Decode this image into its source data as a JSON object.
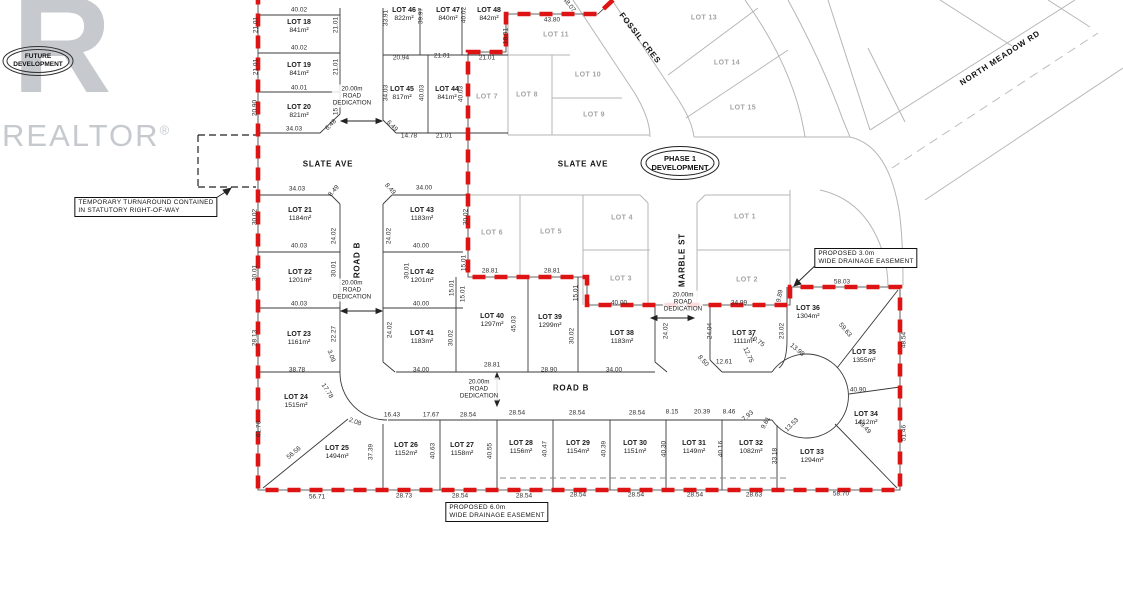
{
  "watermark": {
    "logo_letter": "R",
    "brand": "REALTOR",
    "registered": "®"
  },
  "stamps": [
    {
      "id": "future",
      "line1": "FUTURE",
      "line2": "DEVELOPMENT",
      "x": 38,
      "y": 61
    },
    {
      "id": "phase1",
      "line1": "PHASE 1",
      "line2": "DEVELOPMENT",
      "x": 680,
      "y": 163
    }
  ],
  "streets": [
    {
      "name": "SLATE AVE",
      "x": 328,
      "y": 164,
      "r": 0
    },
    {
      "name": "SLATE AVE",
      "x": 583,
      "y": 164,
      "r": 0
    },
    {
      "name": "FOSSIL CRES",
      "x": 640,
      "y": 38,
      "r": 52
    },
    {
      "name": "NORTH MEADOW RD",
      "x": 1000,
      "y": 58,
      "r": -33
    },
    {
      "name": "MARBLE ST",
      "x": 682,
      "y": 260,
      "r": -90
    },
    {
      "name": "ROAD B",
      "x": 357,
      "y": 260,
      "r": -90
    },
    {
      "name": "ROAD B",
      "x": 571,
      "y": 388,
      "r": 0
    }
  ],
  "dedications": [
    {
      "l1": "20.00m",
      "l2": "ROAD",
      "l3": "DEDICATION",
      "x": 352,
      "y": 96
    },
    {
      "l1": "20.00m",
      "l2": "ROAD",
      "l3": "DEDICATION",
      "x": 352,
      "y": 290
    },
    {
      "l1": "20.00m",
      "l2": "ROAD",
      "l3": "DEDICATION",
      "x": 683,
      "y": 302
    },
    {
      "l1": "20.00m",
      "l2": "ROAD",
      "l3": "DEDICATION",
      "x": 479,
      "y": 389
    }
  ],
  "notes": [
    {
      "l1": "TEMPORARY TURNAROUND CONTAINED",
      "l2": "IN STATUTORY RIGHT-OF-WAY",
      "x": 146,
      "y": 207
    },
    {
      "l1": "PROPOSED 3.0m",
      "l2": "WIDE DRAINAGE EASEMENT",
      "x": 866,
      "y": 258
    },
    {
      "l1": "PROPOSED 6.0m",
      "l2": "WIDE DRAINAGE EASEMENT",
      "x": 497,
      "y": 512
    }
  ],
  "phase_lots": [
    {
      "name": "LOT 18",
      "area": "841m²",
      "x": 299,
      "y": 27
    },
    {
      "name": "LOT 19",
      "area": "841m²",
      "x": 299,
      "y": 70
    },
    {
      "name": "LOT 20",
      "area": "821m²",
      "x": 299,
      "y": 112
    },
    {
      "name": "LOT 21",
      "area": "1184m²",
      "x": 300,
      "y": 215
    },
    {
      "name": "LOT 22",
      "area": "1201m²",
      "x": 300,
      "y": 277
    },
    {
      "name": "LOT 23",
      "area": "1161m²",
      "x": 299,
      "y": 339
    },
    {
      "name": "LOT 24",
      "area": "1515m²",
      "x": 296,
      "y": 402
    },
    {
      "name": "LOT 25",
      "area": "1494m²",
      "x": 337,
      "y": 453
    },
    {
      "name": "LOT 26",
      "area": "1152m²",
      "x": 406,
      "y": 450
    },
    {
      "name": "LOT 27",
      "area": "1158m²",
      "x": 462,
      "y": 450
    },
    {
      "name": "LOT 28",
      "area": "1156m²",
      "x": 521,
      "y": 448
    },
    {
      "name": "LOT 29",
      "area": "1154m²",
      "x": 578,
      "y": 448
    },
    {
      "name": "LOT 30",
      "area": "1151m²",
      "x": 635,
      "y": 448
    },
    {
      "name": "LOT 31",
      "area": "1149m²",
      "x": 694,
      "y": 448
    },
    {
      "name": "LOT 32",
      "area": "1082m²",
      "x": 751,
      "y": 448
    },
    {
      "name": "LOT 33",
      "area": "1294m²",
      "x": 812,
      "y": 457
    },
    {
      "name": "LOT 34",
      "area": "1412m²",
      "x": 866,
      "y": 419
    },
    {
      "name": "LOT 35",
      "area": "1355m²",
      "x": 864,
      "y": 357
    },
    {
      "name": "LOT 36",
      "area": "1304m²",
      "x": 808,
      "y": 313
    },
    {
      "name": "LOT 37",
      "area": "1111m²",
      "x": 744,
      "y": 338
    },
    {
      "name": "LOT 38",
      "area": "1183m²",
      "x": 622,
      "y": 338
    },
    {
      "name": "LOT 39",
      "area": "1299m²",
      "x": 550,
      "y": 322
    },
    {
      "name": "LOT 40",
      "area": "1297m²",
      "x": 492,
      "y": 321
    },
    {
      "name": "LOT 41",
      "area": "1183m²",
      "x": 422,
      "y": 338
    },
    {
      "name": "LOT 42",
      "area": "1201m²",
      "x": 422,
      "y": 277
    },
    {
      "name": "LOT 43",
      "area": "1183m²",
      "x": 422,
      "y": 215
    },
    {
      "name": "LOT 44",
      "area": "841m²",
      "x": 447,
      "y": 94
    },
    {
      "name": "LOT 45",
      "area": "817m²",
      "x": 402,
      "y": 94
    },
    {
      "name": "LOT 46",
      "area": "822m²",
      "x": 404,
      "y": 15
    },
    {
      "name": "LOT 47",
      "area": "840m²",
      "x": 448,
      "y": 15
    },
    {
      "name": "LOT 48",
      "area": "842m²",
      "x": 489,
      "y": 15
    }
  ],
  "future_lots": [
    {
      "name": "LOT 1",
      "x": 745,
      "y": 217
    },
    {
      "name": "LOT 2",
      "x": 747,
      "y": 280
    },
    {
      "name": "LOT 3",
      "x": 621,
      "y": 279
    },
    {
      "name": "LOT 4",
      "x": 622,
      "y": 218
    },
    {
      "name": "LOT 5",
      "x": 551,
      "y": 232
    },
    {
      "name": "LOT 6",
      "x": 492,
      "y": 233
    },
    {
      "name": "LOT 7",
      "x": 487,
      "y": 97
    },
    {
      "name": "LOT 8",
      "x": 527,
      "y": 95
    },
    {
      "name": "LOT 9",
      "x": 594,
      "y": 115
    },
    {
      "name": "LOT 10",
      "x": 588,
      "y": 75
    },
    {
      "name": "LOT 11",
      "x": 556,
      "y": 35
    },
    {
      "name": "LOT 13",
      "x": 704,
      "y": 18
    },
    {
      "name": "LOT 14",
      "x": 727,
      "y": 63
    },
    {
      "name": "LOT 15",
      "x": 743,
      "y": 108
    }
  ],
  "dimensions": [
    {
      "t": "40.02",
      "x": 299,
      "y": 10
    },
    {
      "t": "21.01",
      "x": 256,
      "y": 25,
      "r": -90
    },
    {
      "t": "21.01",
      "x": 336,
      "y": 25,
      "r": -90
    },
    {
      "t": "40.02",
      "x": 299,
      "y": 48
    },
    {
      "t": "21.01",
      "x": 256,
      "y": 67,
      "r": -90
    },
    {
      "t": "21.01",
      "x": 336,
      "y": 67,
      "r": -90
    },
    {
      "t": "40.01",
      "x": 299,
      "y": 88
    },
    {
      "t": "20.90",
      "x": 255,
      "y": 108,
      "r": -90
    },
    {
      "t": "15.01",
      "x": 336,
      "y": 107,
      "r": -90
    },
    {
      "t": "34.03",
      "x": 294,
      "y": 129
    },
    {
      "t": "6.48",
      "x": 331,
      "y": 125,
      "r": -45
    },
    {
      "t": "33.91",
      "x": 386,
      "y": 18,
      "r": -90
    },
    {
      "t": "39.97",
      "x": 421,
      "y": 16,
      "r": -90
    },
    {
      "t": "40.02",
      "x": 464,
      "y": 15,
      "r": -90
    },
    {
      "t": "20.94",
      "x": 401,
      "y": 58
    },
    {
      "t": "21.01",
      "x": 442,
      "y": 56
    },
    {
      "t": "21.01",
      "x": 487,
      "y": 58
    },
    {
      "t": "34.03",
      "x": 386,
      "y": 93,
      "r": -90
    },
    {
      "t": "40.03",
      "x": 422,
      "y": 93,
      "r": -90
    },
    {
      "t": "40.03",
      "x": 461,
      "y": 94,
      "r": -90
    },
    {
      "t": "6.49",
      "x": 392,
      "y": 126,
      "r": 45
    },
    {
      "t": "14.78",
      "x": 409,
      "y": 136
    },
    {
      "t": "21.01",
      "x": 444,
      "y": 136
    },
    {
      "t": "18.91",
      "x": 506,
      "y": 36,
      "r": -90
    },
    {
      "t": "43.80",
      "x": 552,
      "y": 20
    },
    {
      "t": "48.07",
      "x": 569,
      "y": 5,
      "r": 52
    },
    {
      "t": "34.03",
      "x": 297,
      "y": 189
    },
    {
      "t": "8.49",
      "x": 334,
      "y": 191,
      "r": -48
    },
    {
      "t": "8.49",
      "x": 390,
      "y": 189,
      "r": 48
    },
    {
      "t": "34.00",
      "x": 424,
      "y": 188
    },
    {
      "t": "30.02",
      "x": 255,
      "y": 217,
      "r": -90
    },
    {
      "t": "24.02",
      "x": 334,
      "y": 236,
      "r": -90
    },
    {
      "t": "24.02",
      "x": 389,
      "y": 236,
      "r": -90
    },
    {
      "t": "30.02",
      "x": 466,
      "y": 217,
      "r": -90
    },
    {
      "t": "40.03",
      "x": 299,
      "y": 246
    },
    {
      "t": "40.00",
      "x": 421,
      "y": 246
    },
    {
      "t": "30.01",
      "x": 255,
      "y": 273,
      "r": -90
    },
    {
      "t": "30.01",
      "x": 334,
      "y": 269,
      "r": -90
    },
    {
      "t": "30.01",
      "x": 407,
      "y": 271,
      "r": -90
    },
    {
      "t": "15.01",
      "x": 464,
      "y": 263,
      "r": -90
    },
    {
      "t": "15.01",
      "x": 463,
      "y": 294,
      "r": -90
    },
    {
      "t": "40.03",
      "x": 299,
      "y": 304
    },
    {
      "t": "40.00",
      "x": 421,
      "y": 304
    },
    {
      "t": "28.81",
      "x": 490,
      "y": 271
    },
    {
      "t": "28.81",
      "x": 552,
      "y": 271
    },
    {
      "t": "15.01",
      "x": 452,
      "y": 288,
      "r": -90
    },
    {
      "t": "15.01",
      "x": 576,
      "y": 293,
      "r": -90
    },
    {
      "t": "40.00",
      "x": 619,
      "y": 303
    },
    {
      "t": "34.99",
      "x": 739,
      "y": 303
    },
    {
      "t": "28.13",
      "x": 255,
      "y": 338,
      "r": -90
    },
    {
      "t": "22.27",
      "x": 334,
      "y": 334,
      "r": -90
    },
    {
      "t": "24.02",
      "x": 390,
      "y": 330,
      "r": -90
    },
    {
      "t": "30.02",
      "x": 451,
      "y": 338,
      "r": -90
    },
    {
      "t": "45.03",
      "x": 514,
      "y": 324,
      "r": -90
    },
    {
      "t": "30.02",
      "x": 572,
      "y": 336,
      "r": -90
    },
    {
      "t": "24.02",
      "x": 666,
      "y": 331,
      "r": -90
    },
    {
      "t": "24.04",
      "x": 710,
      "y": 331,
      "r": -90
    },
    {
      "t": "23.02",
      "x": 782,
      "y": 331,
      "r": -90
    },
    {
      "t": "9.89",
      "x": 780,
      "y": 296,
      "r": -80
    },
    {
      "t": "58.03",
      "x": 842,
      "y": 282
    },
    {
      "t": "59.63",
      "x": 845,
      "y": 330,
      "r": 50
    },
    {
      "t": "48.54",
      "x": 904,
      "y": 340,
      "r": -90
    },
    {
      "t": "13.98",
      "x": 797,
      "y": 350,
      "r": 40
    },
    {
      "t": "10.75",
      "x": 757,
      "y": 341,
      "r": 35
    },
    {
      "t": "12.75",
      "x": 748,
      "y": 355,
      "r": 65
    },
    {
      "t": "12.61",
      "x": 724,
      "y": 362
    },
    {
      "t": "8.50",
      "x": 703,
      "y": 361,
      "r": 48
    },
    {
      "t": "38.78",
      "x": 297,
      "y": 370
    },
    {
      "t": "3.09",
      "x": 331,
      "y": 356,
      "r": 70
    },
    {
      "t": "34.00",
      "x": 421,
      "y": 370
    },
    {
      "t": "28.81",
      "x": 492,
      "y": 365
    },
    {
      "t": "28.90",
      "x": 549,
      "y": 370
    },
    {
      "t": "34.00",
      "x": 614,
      "y": 370
    },
    {
      "t": "17.78",
      "x": 327,
      "y": 391,
      "r": 58
    },
    {
      "t": "2.08",
      "x": 355,
      "y": 422,
      "r": 20
    },
    {
      "t": "16.43",
      "x": 392,
      "y": 415
    },
    {
      "t": "17.67",
      "x": 431,
      "y": 415
    },
    {
      "t": "28.54",
      "x": 468,
      "y": 415
    },
    {
      "t": "28.54",
      "x": 517,
      "y": 413
    },
    {
      "t": "28.54",
      "x": 577,
      "y": 413
    },
    {
      "t": "28.54",
      "x": 637,
      "y": 413
    },
    {
      "t": "8.15",
      "x": 672,
      "y": 412
    },
    {
      "t": "20.39",
      "x": 702,
      "y": 412
    },
    {
      "t": "8.46",
      "x": 729,
      "y": 412
    },
    {
      "t": "7.93",
      "x": 748,
      "y": 416,
      "r": -40
    },
    {
      "t": "9.61",
      "x": 766,
      "y": 423,
      "r": -62
    },
    {
      "t": "13.53",
      "x": 792,
      "y": 425,
      "r": -45
    },
    {
      "t": "40.90",
      "x": 858,
      "y": 390
    },
    {
      "t": "51.46",
      "x": 904,
      "y": 433,
      "r": -90
    },
    {
      "t": "59.49",
      "x": 864,
      "y": 427,
      "r": 47
    },
    {
      "t": "61.76",
      "x": 259,
      "y": 429,
      "r": -90
    },
    {
      "t": "56.56",
      "x": 294,
      "y": 453,
      "r": -40
    },
    {
      "t": "37.39",
      "x": 371,
      "y": 452,
      "r": -90
    },
    {
      "t": "40.63",
      "x": 433,
      "y": 451,
      "r": -90
    },
    {
      "t": "40.55",
      "x": 490,
      "y": 451,
      "r": -90
    },
    {
      "t": "40.47",
      "x": 545,
      "y": 449,
      "r": -90
    },
    {
      "t": "40.39",
      "x": 604,
      "y": 449,
      "r": -90
    },
    {
      "t": "40.30",
      "x": 664,
      "y": 449,
      "r": -90
    },
    {
      "t": "40.16",
      "x": 721,
      "y": 449,
      "r": -90
    },
    {
      "t": "33.18",
      "x": 775,
      "y": 456,
      "r": -90
    },
    {
      "t": "56.71",
      "x": 317,
      "y": 497
    },
    {
      "t": "28.73",
      "x": 404,
      "y": 496
    },
    {
      "t": "28.54",
      "x": 460,
      "y": 496
    },
    {
      "t": "28.54",
      "x": 524,
      "y": 496
    },
    {
      "t": "28.54",
      "x": 578,
      "y": 495
    },
    {
      "t": "28.54",
      "x": 636,
      "y": 495
    },
    {
      "t": "28.54",
      "x": 695,
      "y": 495
    },
    {
      "t": "28.63",
      "x": 754,
      "y": 495
    },
    {
      "t": "58.70",
      "x": 841,
      "y": 494
    }
  ]
}
